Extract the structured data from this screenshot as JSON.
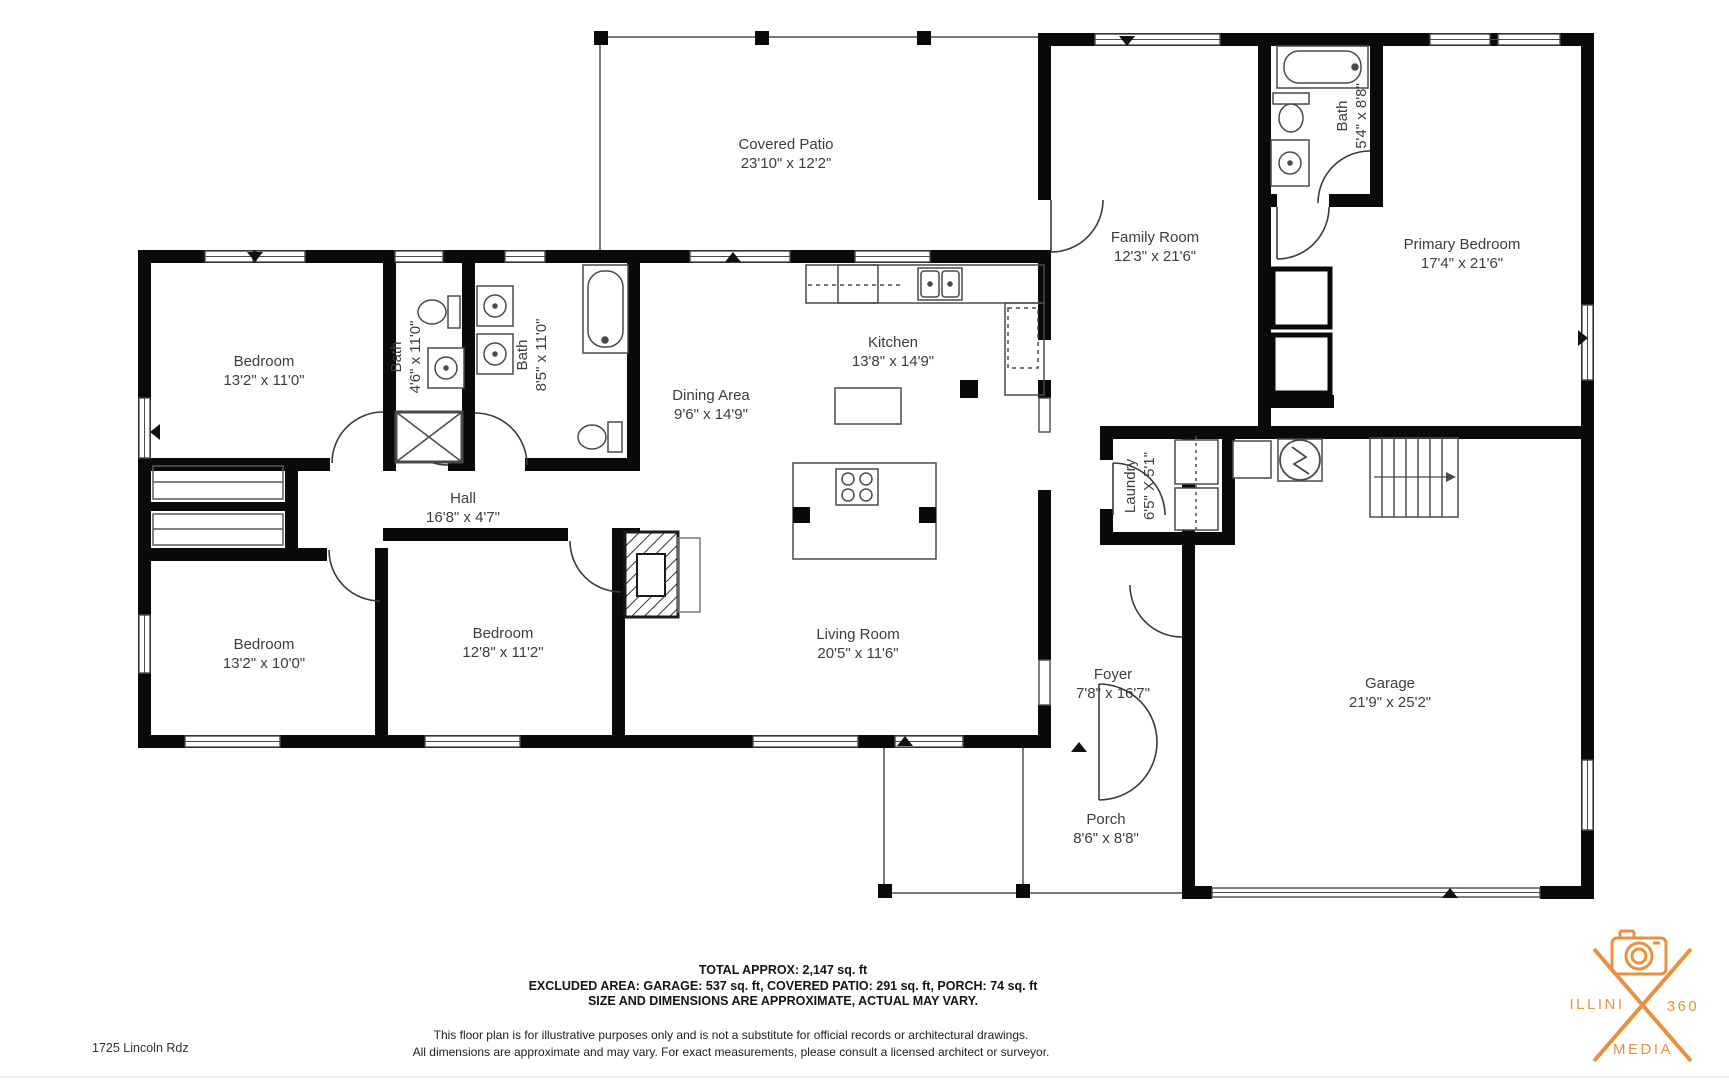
{
  "rooms": [
    {
      "name": "Covered Patio",
      "dims": "23'10\" x 12'2\""
    },
    {
      "name": "Family Room",
      "dims": "12'3\" x 21'6\""
    },
    {
      "name": "Bath",
      "dims": "5'4\" x 8'8\""
    },
    {
      "name": "Primary Bedroom",
      "dims": "17'4\" x 21'6\""
    },
    {
      "name": "Bedroom",
      "dims": "13'2\" x 11'0\""
    },
    {
      "name": "Bath",
      "dims": "4'6\" x 11'0\""
    },
    {
      "name": "Bath",
      "dims": "8'5\" x 11'0\""
    },
    {
      "name": "Dining Area",
      "dims": "9'6\" x 14'9\""
    },
    {
      "name": "Kitchen",
      "dims": "13'8\" x 14'9\""
    },
    {
      "name": "Hall",
      "dims": "16'8\" x 4'7\""
    },
    {
      "name": "Laundry",
      "dims": "6'5\" X 5'1\""
    },
    {
      "name": "Bedroom",
      "dims": "13'2\" x 10'0\""
    },
    {
      "name": "Bedroom",
      "dims": "12'8\" x 11'2\""
    },
    {
      "name": "Living Room",
      "dims": "20'5\" x 11'6\""
    },
    {
      "name": "Foyer",
      "dims": "7'8\" x 16'7\""
    },
    {
      "name": "Garage",
      "dims": "21'9\" x 25'2\""
    },
    {
      "name": "Porch",
      "dims": "8'6\" x 8'8\""
    }
  ],
  "footer": {
    "line1": "TOTAL APPROX: 2,147 sq. ft",
    "line2": "EXCLUDED AREA: GARAGE: 537 sq. ft, COVERED PATIO: 291 sq. ft, PORCH: 74 sq. ft",
    "line3": "SIZE AND DIMENSIONS ARE APPROXIMATE, ACTUAL MAY VARY."
  },
  "disclaimer": {
    "line1": "This floor plan is for illustrative purposes only and is not a substitute for official records or architectural drawings.",
    "line2": "All dimensions are approximate and may vary. For exact measurements, please consult a licensed architect or surveyor."
  },
  "address": "1725 Lincoln Rdz",
  "logo": {
    "left": "ILLINI",
    "right": "360",
    "bottom": "MEDIA",
    "accent_color": "#E8913F"
  }
}
